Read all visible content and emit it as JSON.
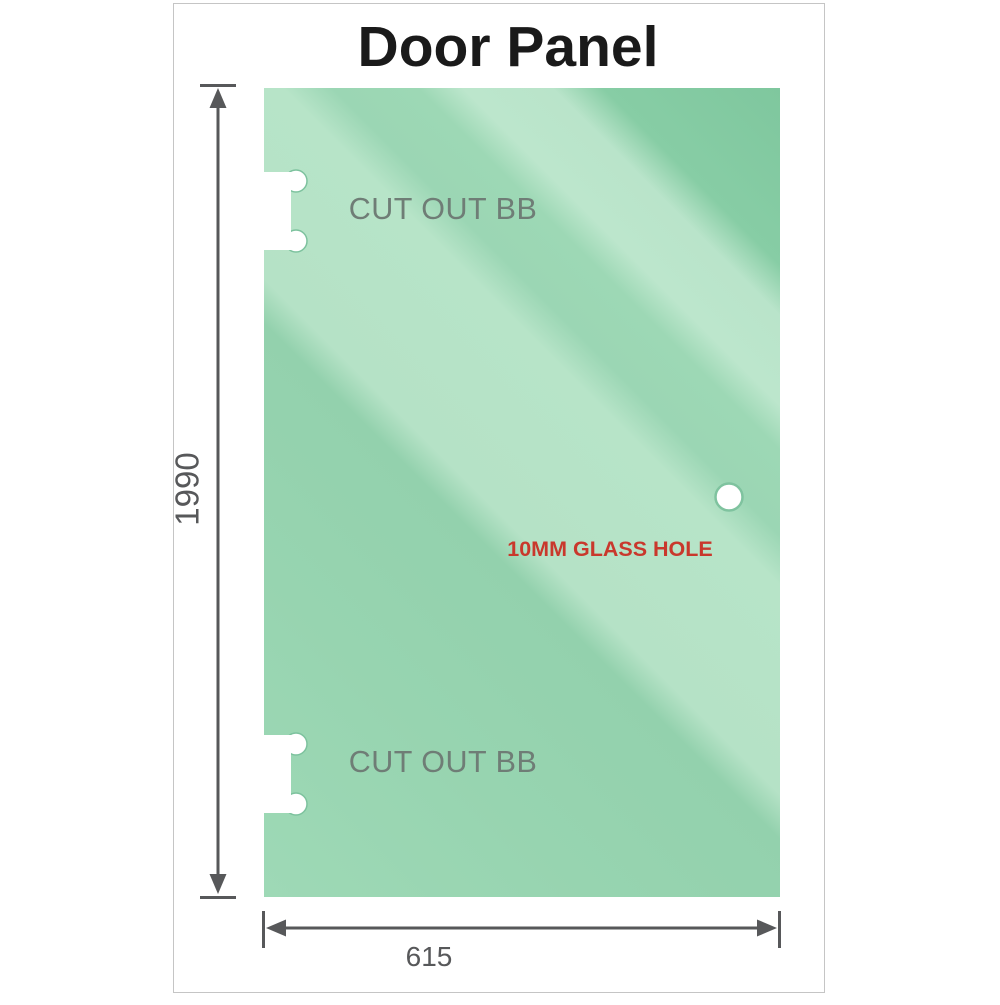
{
  "page": {
    "title": "Door Panel"
  },
  "panel": {
    "cutout_top_label": "CUT OUT BB",
    "cutout_bottom_label": "CUT OUT BB",
    "hole_label": "10MM GLASS HOLE",
    "height_dimension": "1990",
    "width_dimension": "615"
  },
  "colors": {
    "glass_base": "#8fd0ab",
    "glass_highlight": "#bae5cb",
    "glass_shadow": "#7fc79e",
    "dimension_lines": "#57585a",
    "cutout_label_text": "#6f7d76",
    "hole_label_text": "#c9382c",
    "title_text": "#1a1a1a",
    "hole_ring": "#7fc39f",
    "page_border": "#c5c5c5"
  }
}
